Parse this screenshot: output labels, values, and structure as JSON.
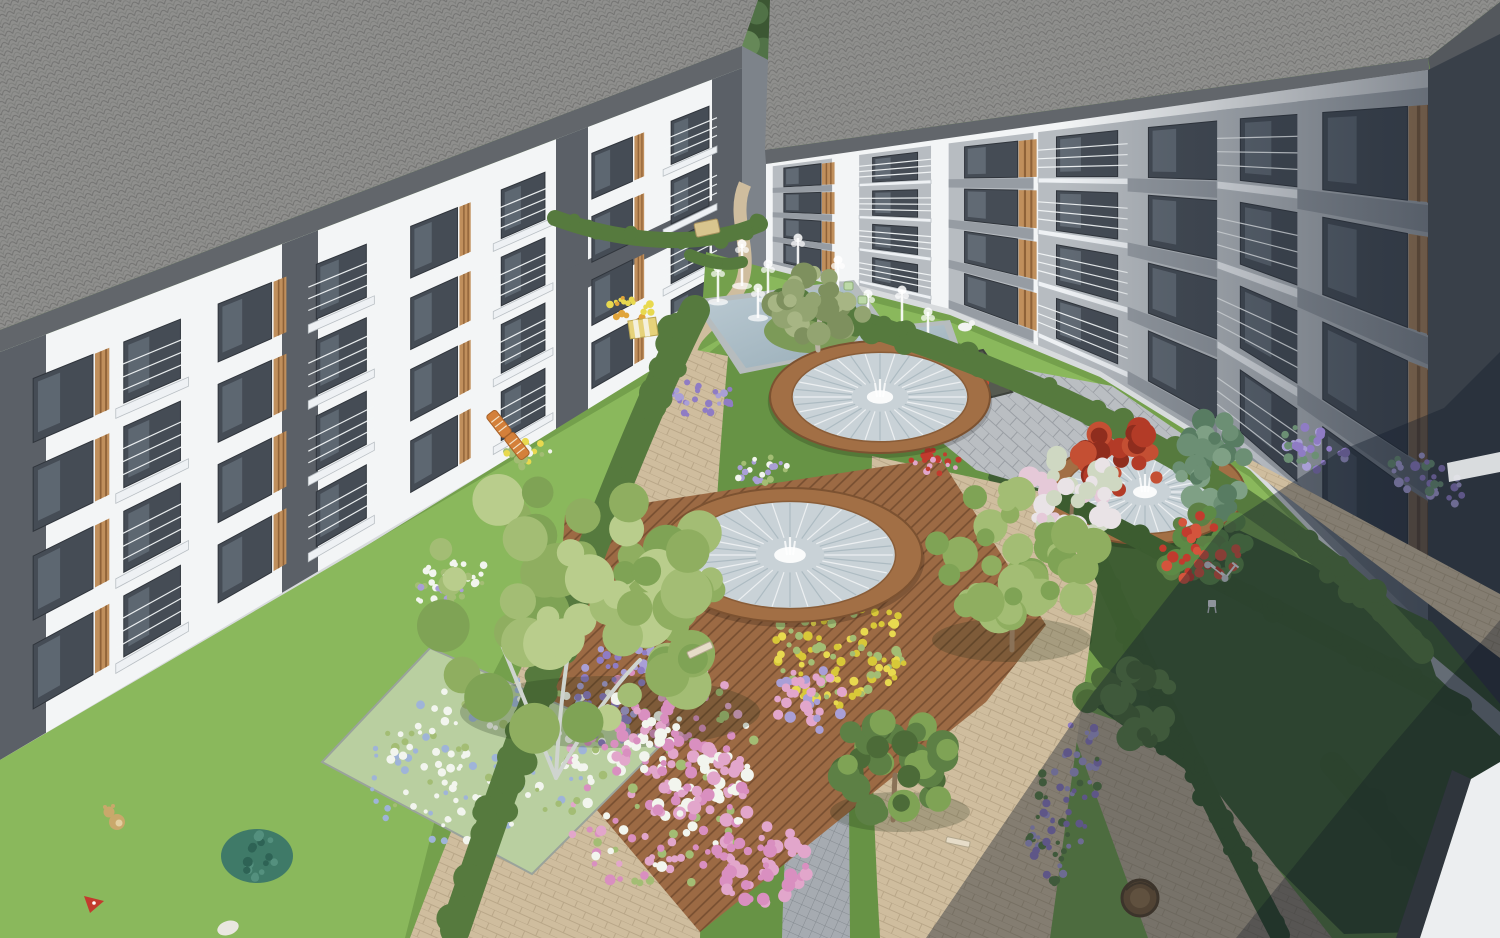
{
  "scene": {
    "type": "architectural-render",
    "title": "Aerial rendering of a modern apartment complex courtyard with landscaped gardens and fountains",
    "description": "Two white four-storey apartment blocks with grey roofs, balconies and timber louvers frame a landscaped courtyard containing an angular fountain pond, three circular timber-edged fountains, timber decking, paved walkways, lawns, hedges and flower beds",
    "time_of_day": "daytime",
    "elements": [
      "left apartment building",
      "right apartment building",
      "background trees",
      "fountain pond with water jets",
      "three circular timber fountains",
      "timber deck",
      "paved walkways",
      "stone plaza",
      "flower beds",
      "hedges",
      "lawns",
      "garden furniture",
      "children's toys",
      "scooter",
      "wicker chair"
    ],
    "palette": {
      "bg_tree_dark": "#3c5733",
      "bg_tree_mid": "#517247",
      "bg_tree_light": "#668858",
      "gap_grass": "#b7cb8c",
      "roof": "#8f8f8d",
      "fascia": "#62666b",
      "roof_dark": "#54585d",
      "facade_white": "#f3f5f6",
      "bay_grey": "#b7bcc1",
      "spandrel": "#9298a0",
      "pier_dark": "#5b6067",
      "window_glass": "#454c55",
      "win_frame": "#30353c",
      "wood_slat": "#c08f5c",
      "wood_slat_dark": "#8f6238",
      "balcony_rail": "#f2f5f7",
      "slab": "#eef1f4",
      "plinth": "#d8dbdd",
      "side_return": "#7d838a",
      "grass": "#74a04c",
      "lawn_bright": "#8ab85c",
      "lawn_mid": "#679345",
      "lawn_dark": "#3f5e33",
      "hedge": "#567a3e",
      "hedge_dark": "#3c5c30",
      "path_tan": "#cfbd9e",
      "path_tan_dark": "#b9ab92",
      "cobble": "#a6abb1",
      "plaza": "#babec2",
      "walkway_grey": "#9aa0a5",
      "deck": "#9c6a44",
      "pond_rim": "#b6bcbe",
      "water_hi": "#bccbd3",
      "water_lo": "#96abb6",
      "island": "#7c9a58",
      "fountain_rim": "#a26f45",
      "fountain_water": "#c9d2d7",
      "spray": "#ffffff",
      "planter_soil": "#565a50",
      "tree_g1": "#a3bd74",
      "tree_g2": "#8fae60",
      "tree_g3": "#7fa355",
      "tree_g4": "#5d8045",
      "tree_dark": "#4c6b38",
      "olive1": "#93a471",
      "olive2": "#a7b584",
      "trunk_white": "#cfd4cf",
      "trunk_brown": "#8a7258",
      "maple": "#b33b27",
      "maple_dark": "#8f2d1e",
      "conifer": "#6c8f74",
      "conifer_dark": "#587c62",
      "blossom_white": "#e9e3e6",
      "blossom_pink": "#e5c9d8",
      "fl_pink": "#e2a6cb",
      "fl_pink2": "#d98fc0",
      "fl_purple": "#8f7cc4",
      "fl_lavender": "#a99fd6",
      "fl_yellow": "#e8d94f",
      "fl_white": "#f2f5ee",
      "fl_red": "#c23b2e",
      "fl_blue": "#9fb4d8",
      "teal_bush": "#3f7a68",
      "teddy": "#c9a86b",
      "prop_orange": "#d4803a",
      "wicker": "#7a5d39",
      "scooter_white": "#e8eaec",
      "cat_white": "#f2f3f1",
      "shade_overlay": "rgba(20,29,44,0.40)",
      "shade_deep": "rgba(13,20,32,0.30)",
      "wall_white": "#eceef0",
      "wall_dark": "#394049",
      "sliver_dark": "#2f353c"
    }
  }
}
